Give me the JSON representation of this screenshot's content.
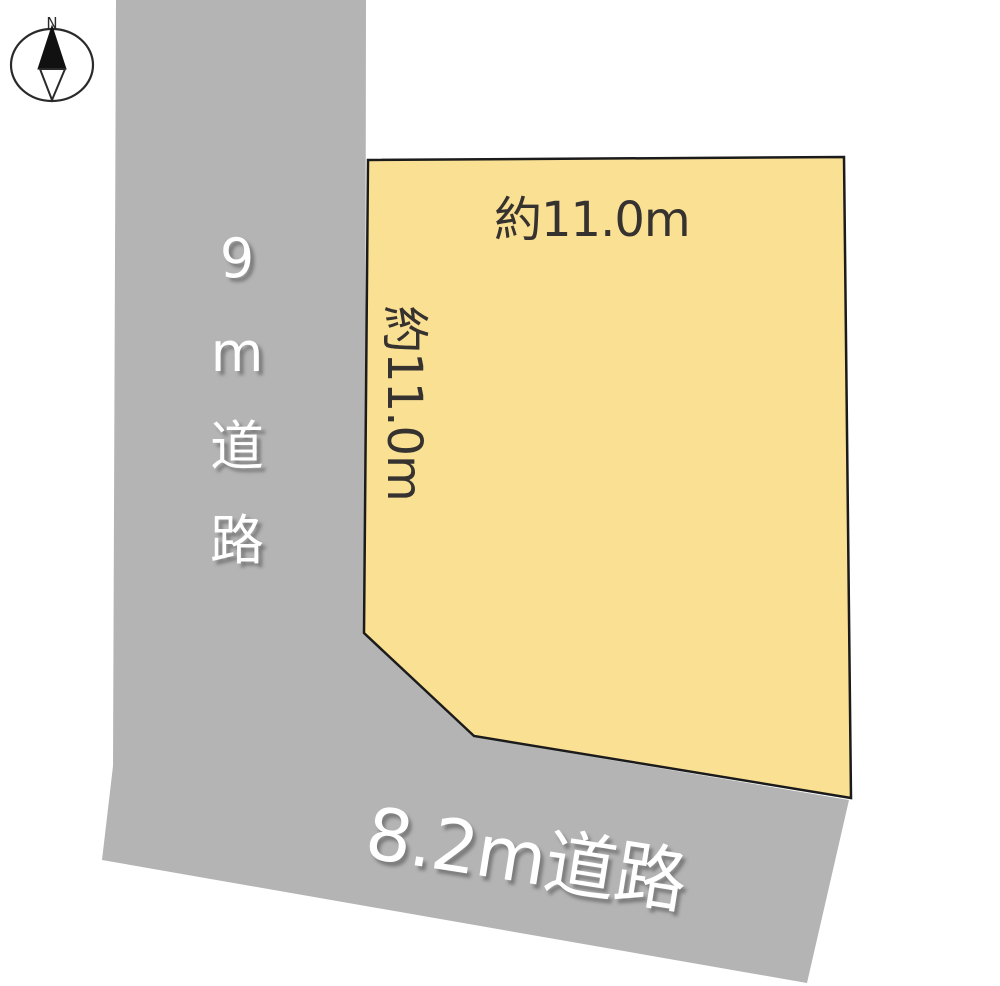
{
  "compass": {
    "north_label": "N"
  },
  "roads": {
    "west": {
      "label": "9m道路"
    },
    "south": {
      "label": "8.2m道路"
    }
  },
  "lot": {
    "top_dimension": "約11.0m",
    "left_dimension": "約11.0m"
  },
  "colors": {
    "road_fill": "#b4b4b4",
    "lot_fill": "#fae093",
    "lot_border": "#1b1b1b",
    "road_label_text": "#ffffff",
    "dimension_text": "#363230",
    "compass_stroke": "#2a2a2a"
  }
}
